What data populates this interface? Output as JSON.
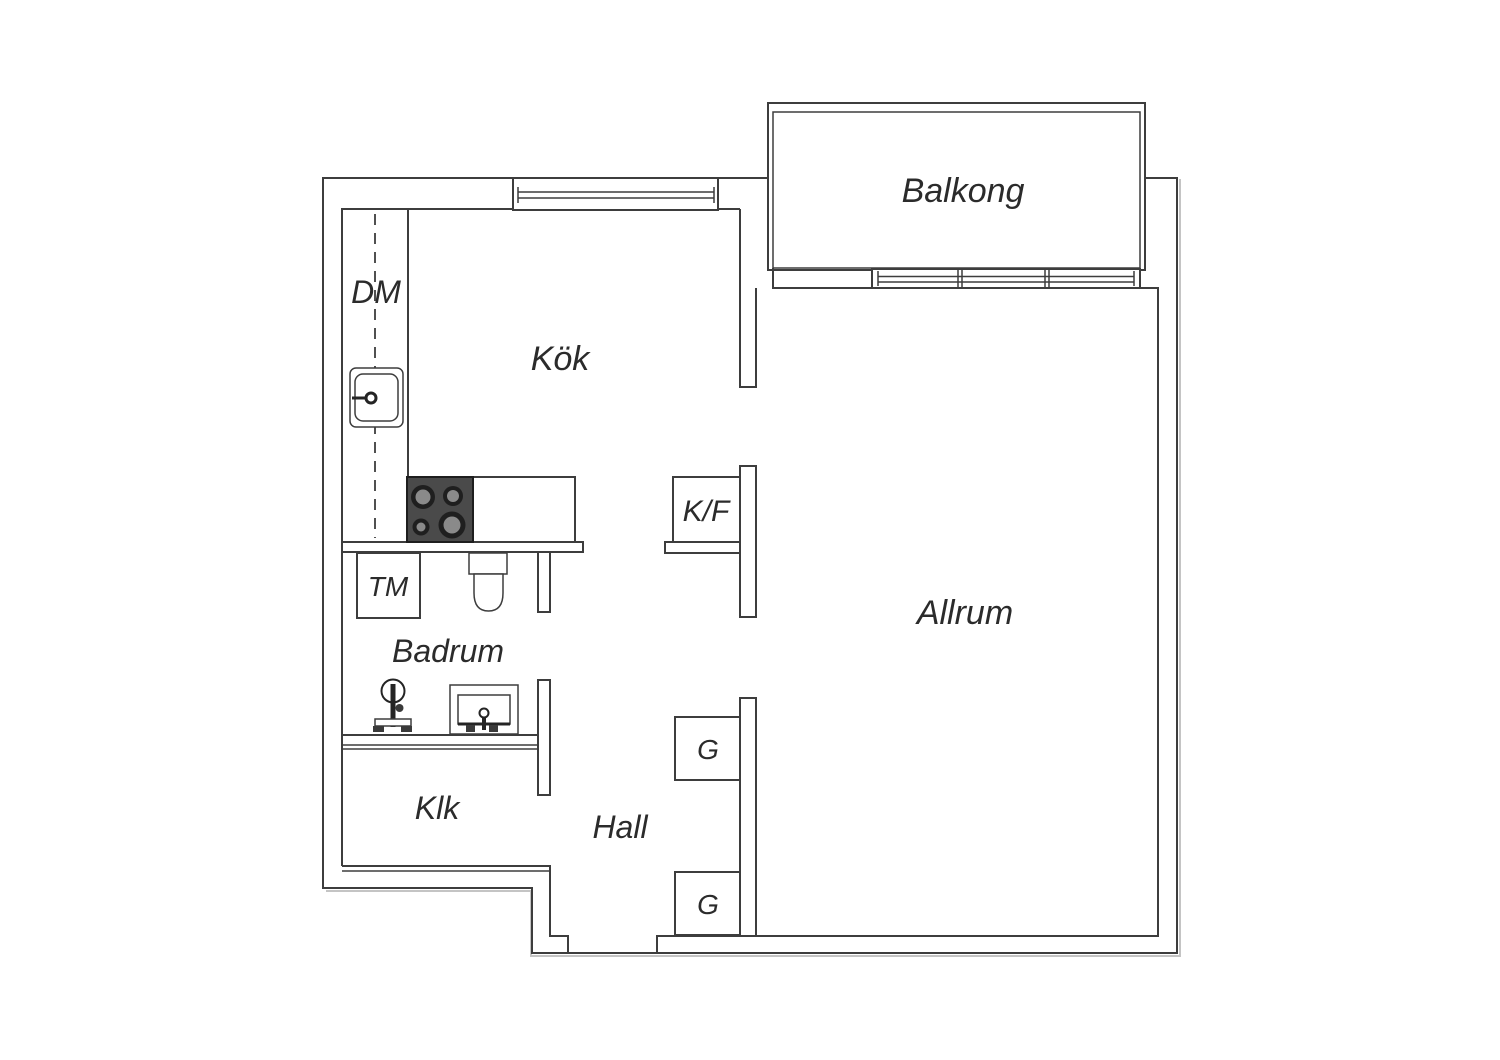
{
  "plan": {
    "rooms": [
      {
        "id": "balkong",
        "label": "Balkong"
      },
      {
        "id": "kok",
        "label": "Kök"
      },
      {
        "id": "allrum",
        "label": "Allrum"
      },
      {
        "id": "badrum",
        "label": "Badrum"
      },
      {
        "id": "hall",
        "label": "Hall"
      },
      {
        "id": "klk",
        "label": "Klk"
      }
    ],
    "fixtures": [
      {
        "id": "dishwasher",
        "label": "DM"
      },
      {
        "id": "fridge-freezer",
        "label": "K/F"
      },
      {
        "id": "washing-machine",
        "label": "TM"
      },
      {
        "id": "wardrobe-1",
        "label": "G"
      },
      {
        "id": "wardrobe-2",
        "label": "G"
      }
    ],
    "colors": {
      "wall": "#3d3d3d",
      "line_light": "#c4c4c4",
      "stove": "#4a4a4a",
      "burner_ring": "#1f1f1f",
      "burner_inner": "#8a8a8a",
      "fixture_dark": "#3a3a3a",
      "text": "#2b2b2b",
      "background": "#ffffff"
    }
  }
}
